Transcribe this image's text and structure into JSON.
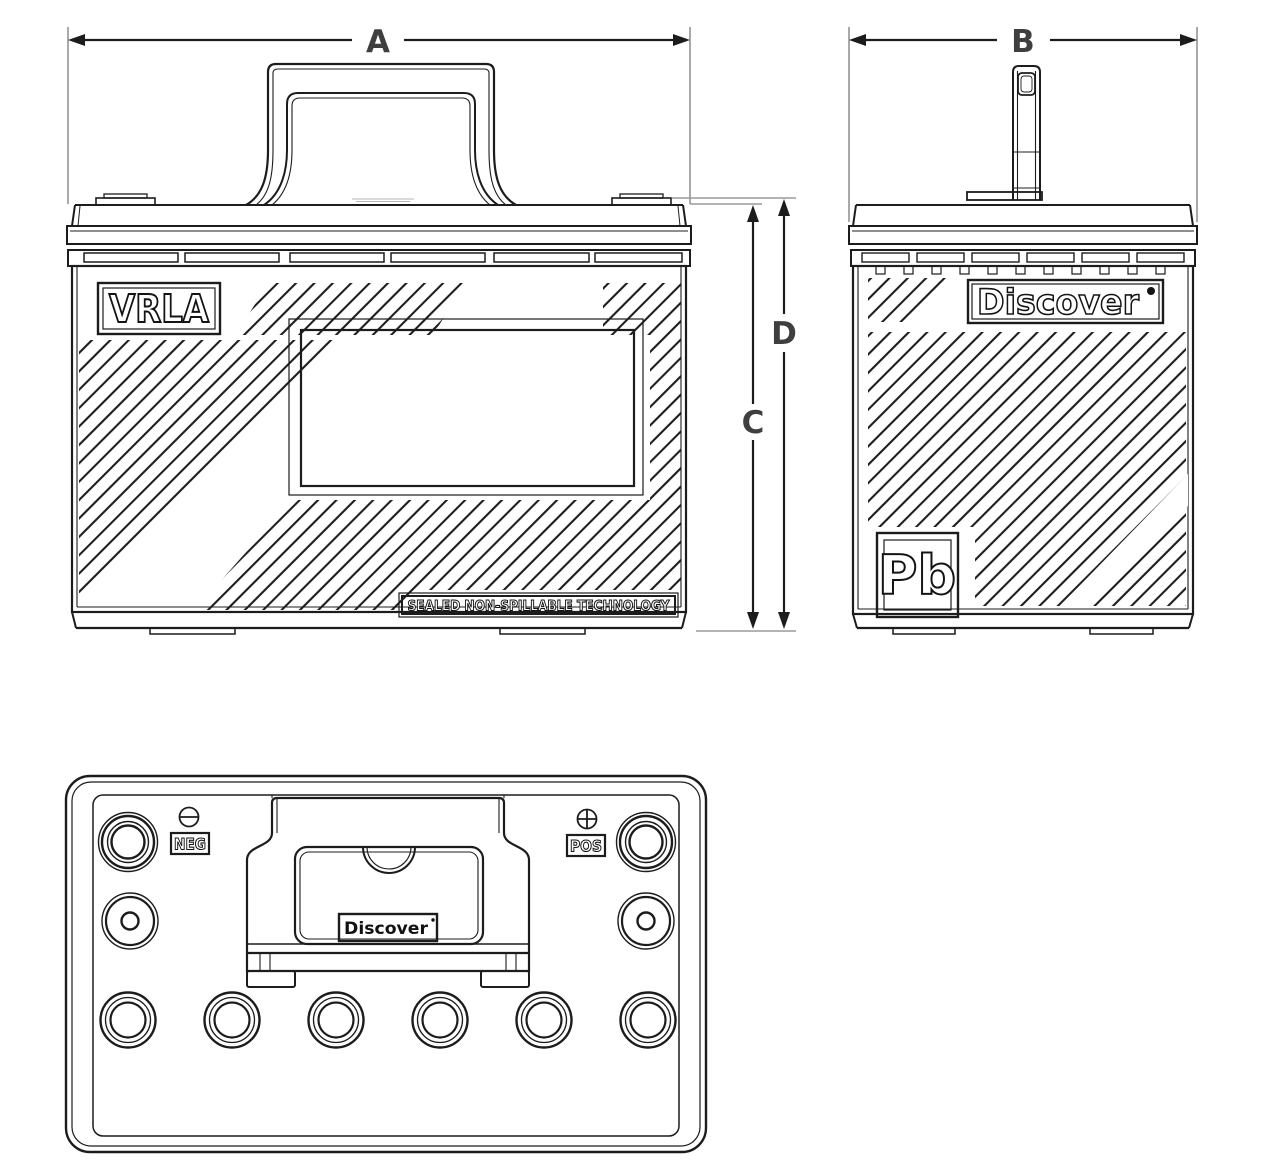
{
  "drawing": {
    "dimensions": {
      "width_label": "A",
      "depth_label": "B",
      "case_height_label": "C",
      "total_height_label": "D"
    },
    "front_view": {
      "vrla_label": "VRLA",
      "sealed_label": "SEALED NON-SPILLABLE TECHNOLOGY"
    },
    "side_view": {
      "brand_label": "Discover",
      "lead_symbol": "Pb"
    },
    "top_view": {
      "negative_label": "NEG",
      "positive_label": "POS",
      "brand_label": "Discover"
    }
  },
  "colors": {
    "line": "#1c1c1c",
    "dimension_label": "#3f3f3f",
    "extension_line": "#9a9a9a",
    "background": "#ffffff"
  }
}
